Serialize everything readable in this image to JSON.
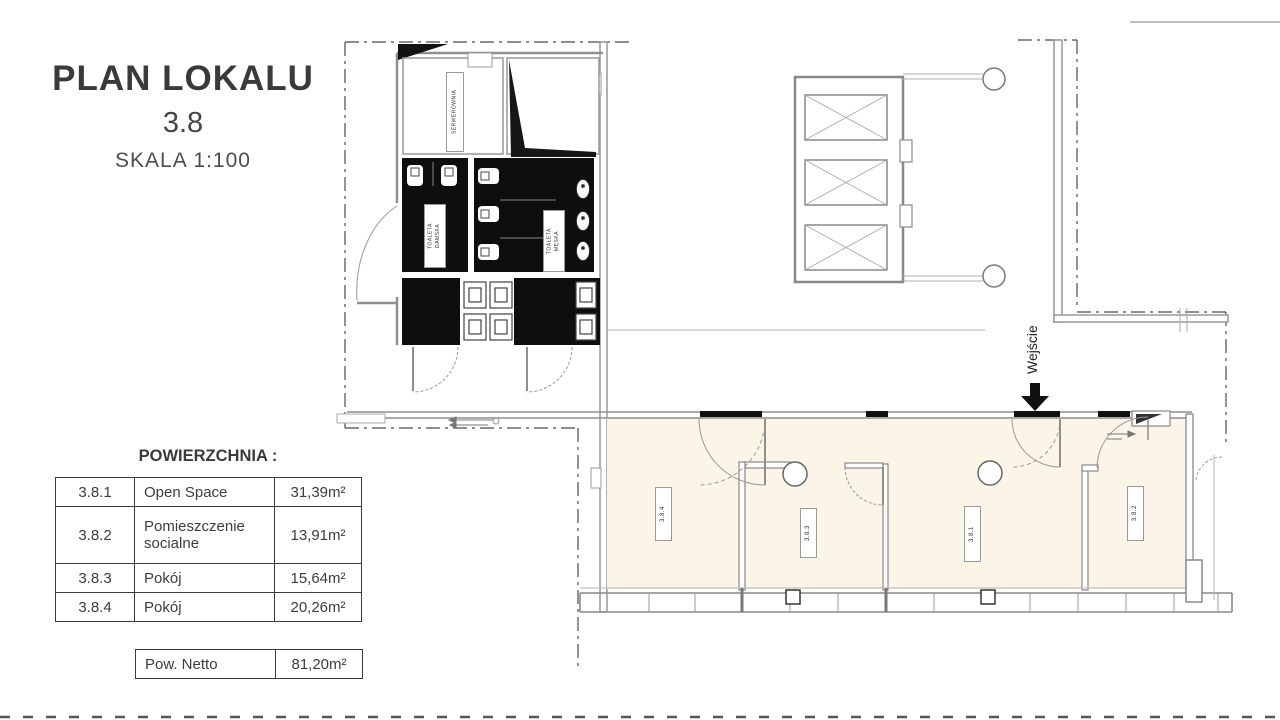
{
  "title_block": {
    "title": "PLAN LOKALU",
    "unit": "3.8",
    "scale": "SKALA 1:100"
  },
  "area_table": {
    "heading": "POWIERZCHNIA :",
    "rows": [
      {
        "id": "3.8.1",
        "name": "Open Space",
        "area": "31,39m²"
      },
      {
        "id": "3.8.2",
        "name": "Pomieszczenie socialne",
        "area": "13,91m²"
      },
      {
        "id": "3.8.3",
        "name": "Pokój",
        "area": "15,64m²"
      },
      {
        "id": "3.8.4",
        "name": "Pokój",
        "area": "20,26m²"
      }
    ],
    "net_row": {
      "name": "Pow. Netto",
      "area": "81,20m²"
    }
  },
  "plan": {
    "rooms": {
      "serwerownia": "SERWEROWNIA",
      "toaleta_damska": "TOALETA\nDAMSKA",
      "toaleta_meska": "TOALETA\nMĘSKA",
      "room_3_8_1": "3.8.1",
      "room_3_8_2": "3.8.2",
      "room_3_8_3": "3.8.3",
      "room_3_8_4": "3.8.4"
    },
    "entrance_label": "Wejście"
  },
  "colors": {
    "room_fill": "#faf5e7",
    "wall_gray": "#8f8f8f",
    "ink": "#3c3c3c",
    "fixture_black": "#0e0e0e"
  }
}
